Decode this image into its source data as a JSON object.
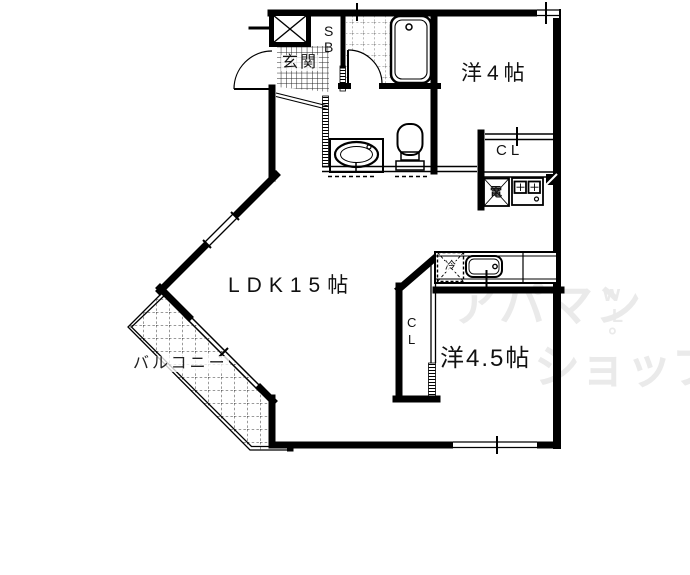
{
  "floor_plan": {
    "rooms": {
      "ldk": {
        "label": "LDK15帖"
      },
      "western_room_4": {
        "label": "洋4帖"
      },
      "western_room_4_5": {
        "label": "洋4.5帖"
      },
      "balcony": {
        "label": "バルコニー"
      },
      "entrance": {
        "label": "玄関"
      }
    },
    "storage": {
      "shoe_box": {
        "letter_top": "S",
        "letter_bottom": "B"
      },
      "closet_upper": {
        "label": "CL"
      },
      "closet_lower": {
        "letter_top": "C",
        "letter_bottom": "L"
      }
    },
    "fixtures": {
      "electric_water_heater": {
        "label": "電"
      },
      "refrigerator_space": {
        "label": "冷"
      }
    },
    "colors": {
      "line": "#000000",
      "background": "#ffffff",
      "watermark": "#eaeaea"
    }
  },
  "watermark": {
    "line1": "アパマン",
    "line2": "ショップ",
    "mark_top": "w",
    "mark_mid": "L",
    "mark_bottom": "°"
  }
}
